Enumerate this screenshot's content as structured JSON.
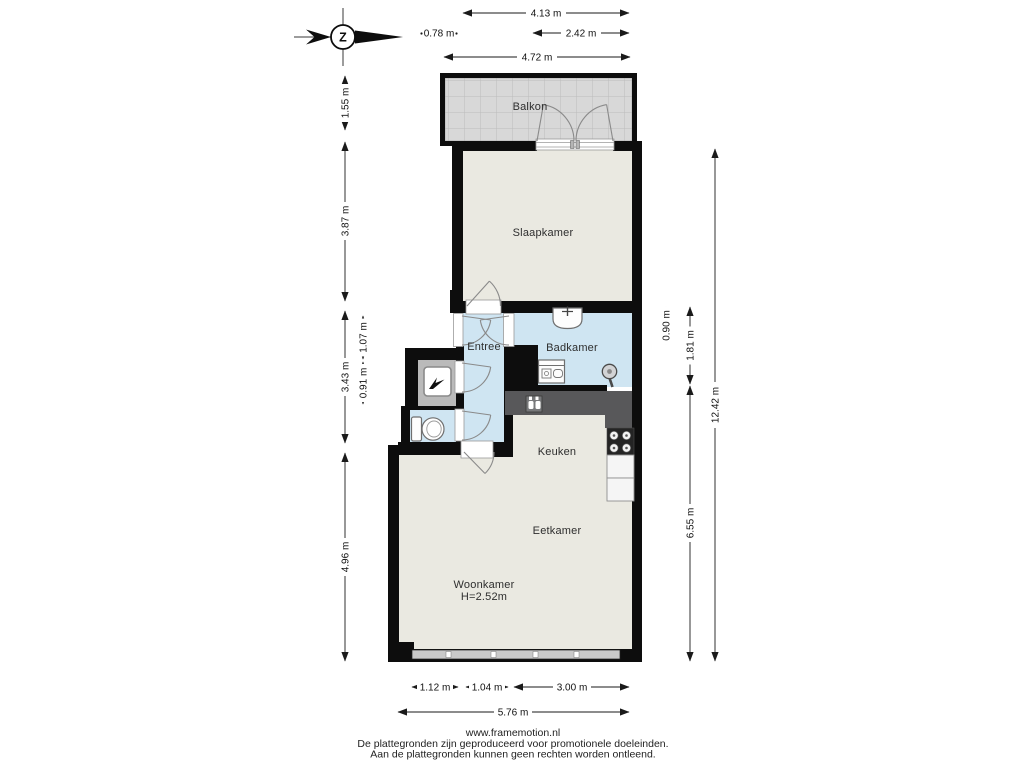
{
  "compass": {
    "letter": "Z"
  },
  "rooms": {
    "balkon": "Balkon",
    "slaapkamer": "Slaapkamer",
    "entree": "Entree",
    "badkamer": "Badkamer",
    "keuken": "Keuken",
    "eetkamer": "Eetkamer",
    "woonkamer": "Woonkamer",
    "woonkamer_height": "H=2.52m"
  },
  "dimensions": {
    "top": {
      "d413": "4.13 m",
      "d078": "0.78 m",
      "d242": "2.42 m",
      "d472": "4.72 m"
    },
    "left": {
      "d155": "1.55 m",
      "d387": "3.87 m",
      "d343": "3.43 m",
      "d107": "1.07 m",
      "d091": "0.91 m",
      "d496": "4.96 m"
    },
    "right": {
      "d090": "0.90 m",
      "d181": "1.81 m",
      "d655": "6.55 m",
      "d1242": "12.42 m"
    },
    "bottom": {
      "d112": "1.12 m",
      "d104": "1.04 m",
      "d300": "3.00 m",
      "d576": "5.76 m"
    }
  },
  "footer": {
    "website": "www.framemotion.nl",
    "disclaimer_line1": "De plattegronden zijn geproduceerd voor promotionele doeleinden.",
    "disclaimer_line2": "Aan de plattegronden kunnen geen rechten worden ontleend."
  },
  "colors": {
    "wall": "#0d0d0d",
    "floor": "#eae9e1",
    "wet_room": "#cfe5f2",
    "balcony_tile": "#d8d8d8",
    "closet_floor": "#bababa",
    "counter": "#58585a",
    "stove": "#242424"
  }
}
